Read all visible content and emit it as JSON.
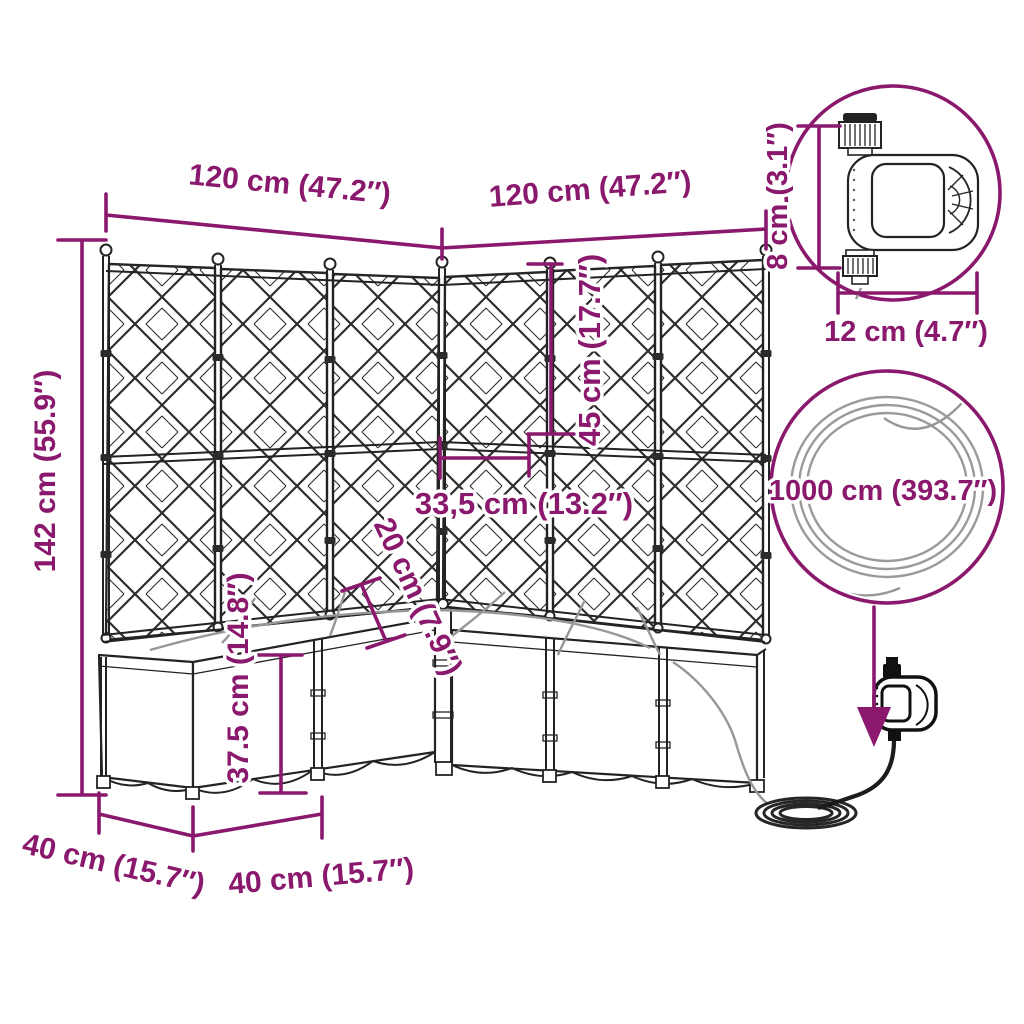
{
  "diagram": {
    "type": "product-dimension-diagram",
    "subject": "garden planter with trellis and automatic watering set",
    "accent_color": "#8A186D",
    "drawing_color": "#232323",
    "hose_color": "#979797",
    "dimensions": {
      "top_width_left": "120 cm (47.2″)",
      "top_width_right": "120 cm (47.2″)",
      "total_height": "142 cm (55.9″)",
      "upper_trellis_height": "45 cm (17.7″)",
      "panel_section_width": "33,5 cm (13.2″)",
      "emitter_spacing": "20 cm (7.9″)",
      "planter_box_height": "37.5 cm (14.8″)",
      "side_depth": "40 cm (15.7″)",
      "front_depth": "40 cm (15.7″)",
      "timer_height": "8 cm (3.1″)",
      "timer_width": "12 cm (4.7″)",
      "hose_length": "1000 cm (393.7″)"
    }
  }
}
